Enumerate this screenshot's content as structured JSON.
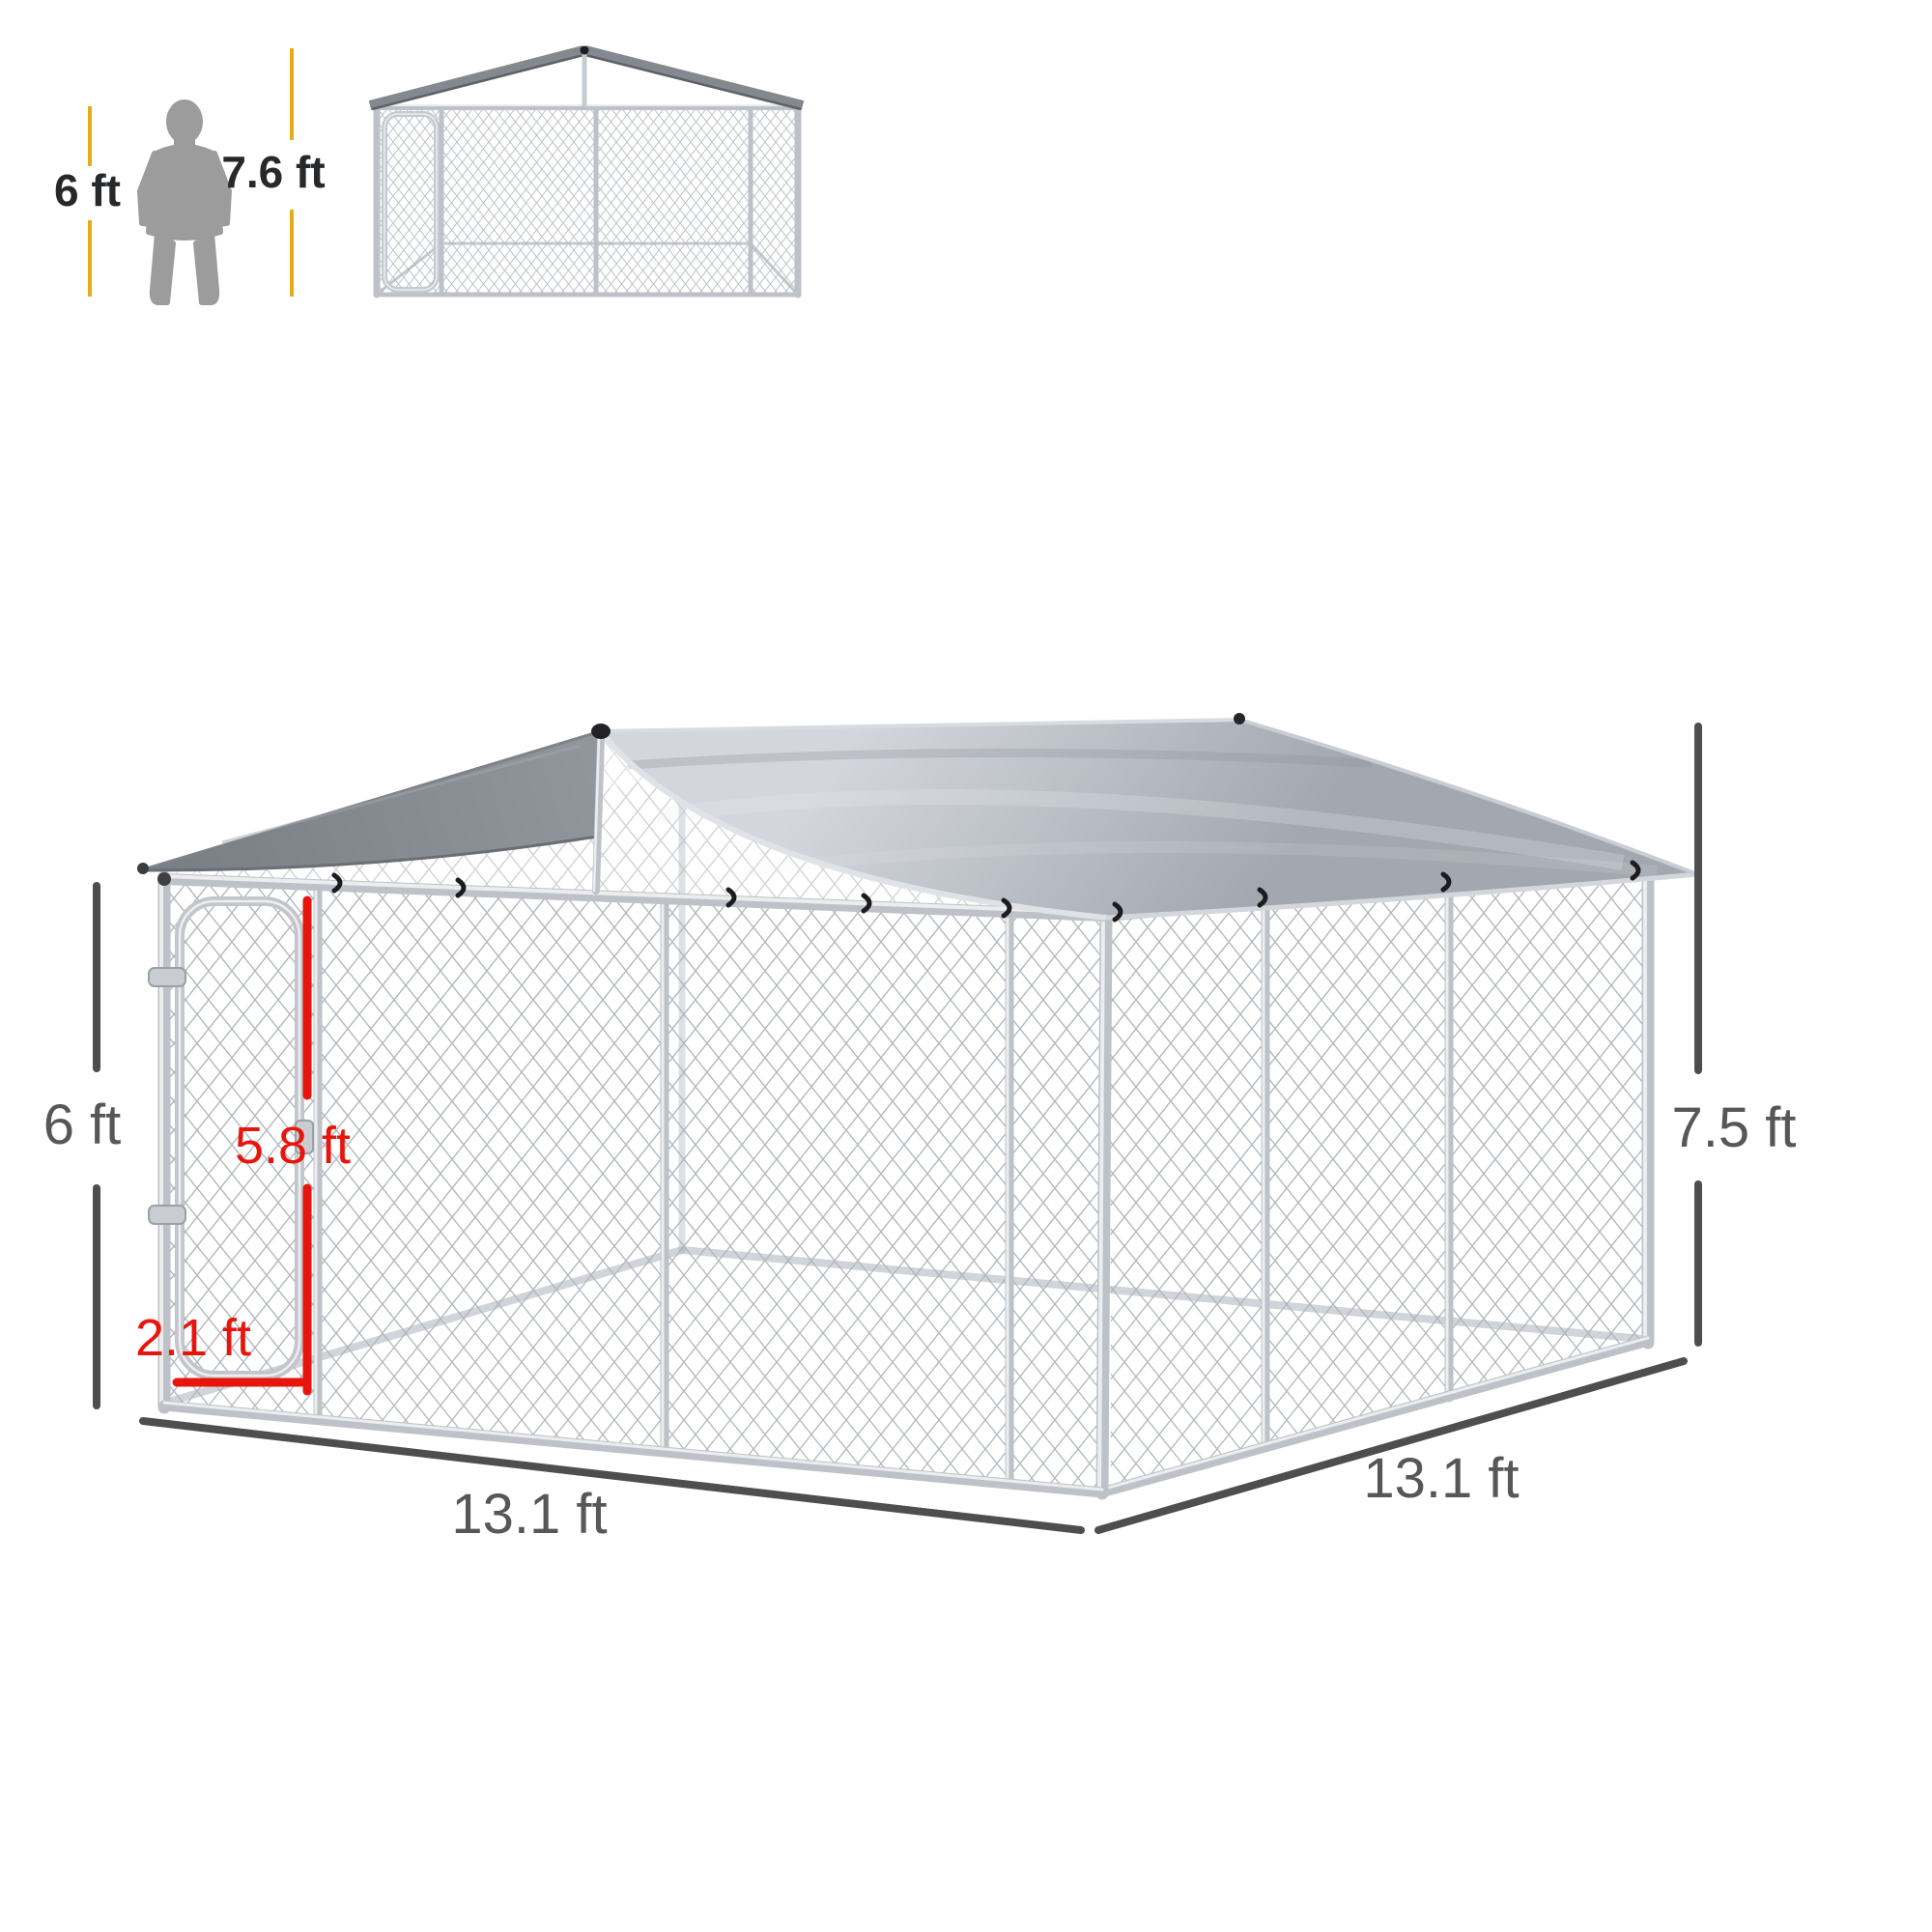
{
  "title": "Outdoor dog kennel with canopy roof - dimension diagram",
  "scale_reference": {
    "person_height_label": "6 ft",
    "peak_height_label": "7.6 ft"
  },
  "dimensions": {
    "wall_height_label": "6 ft",
    "door_height_label": "5.8 ft",
    "door_width_label": "2.1 ft",
    "front_width_label": "13.1 ft",
    "side_depth_label": "13.1 ft",
    "overall_height_label": "7.5 ft"
  },
  "colors": {
    "accent_yellow": "#E2AC1B",
    "dimension_red": "#E8150C",
    "dimension_gray": "#4E4E4E",
    "label_dark": "#26282A",
    "label_gray": "#575757",
    "figure_gray": "#9C9C9C",
    "tarp_light_1": "#D3D6DC",
    "tarp_light_2": "#A2A7B0",
    "tarp_dark_1": "#92969D",
    "tarp_dark_2": "#787C83",
    "frame_metal": "#BEC2C8",
    "frame_highlight": "#EBEDEF",
    "mesh_wire": "#AFB4BB",
    "clip_black": "#1C1C1E"
  }
}
